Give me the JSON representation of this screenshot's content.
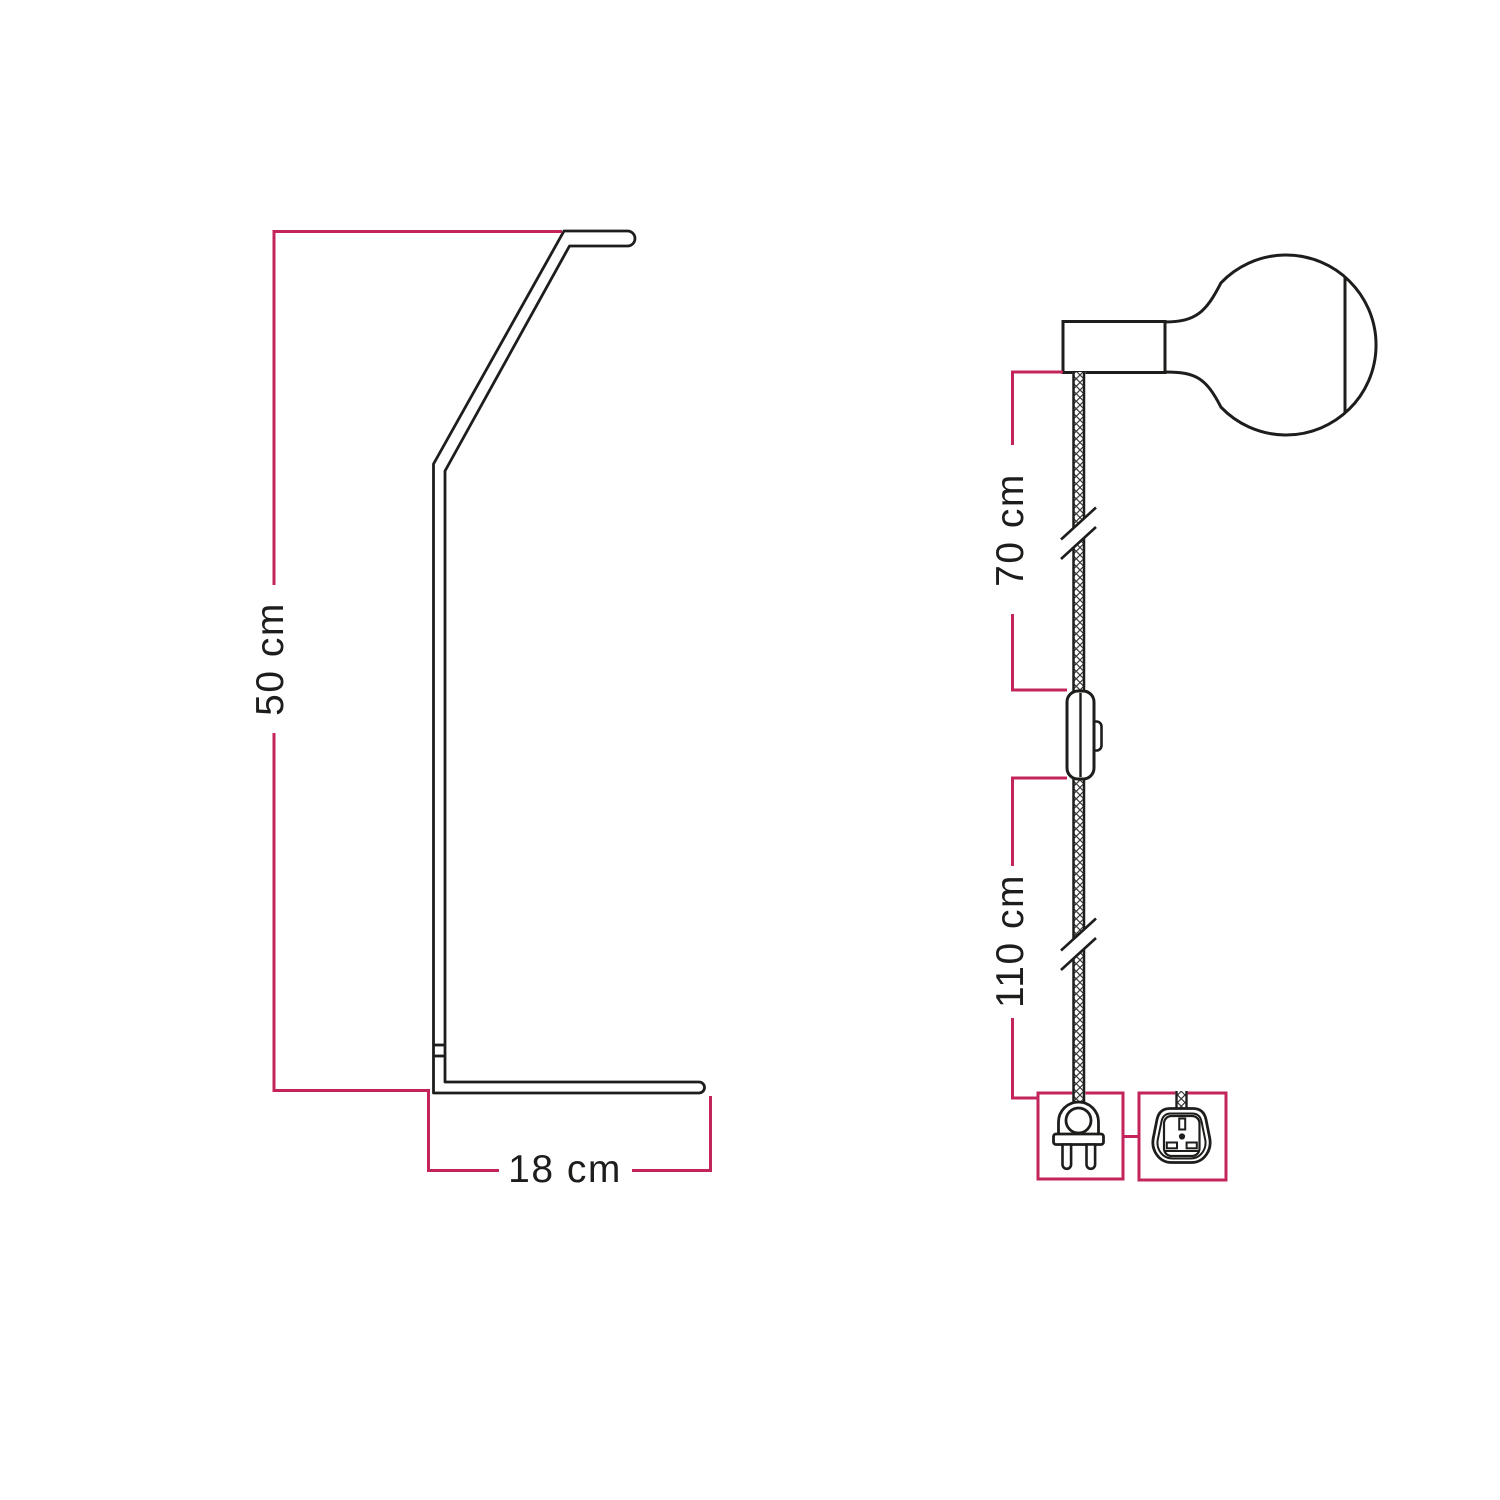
{
  "colors": {
    "accent": "#c4245c",
    "line": "#1d1d1b",
    "background": "#ffffff"
  },
  "stand_diagram": {
    "name": "table-lamp-stand-side-profile",
    "height_label": "50 cm",
    "base_label": "18 cm"
  },
  "pendant_diagram": {
    "name": "plug-in-pendant-cable-with-bulb",
    "upper_cable_label": "70 cm",
    "lower_cable_label": "110 cm",
    "icons": {
      "bulb": "globe-bulb-icon",
      "switch": "inline-switch-icon",
      "euro_plug": "two-pin-plug-icon",
      "uk_plug": "uk-plug-icon",
      "cable_break": "cable-break-mark"
    }
  }
}
